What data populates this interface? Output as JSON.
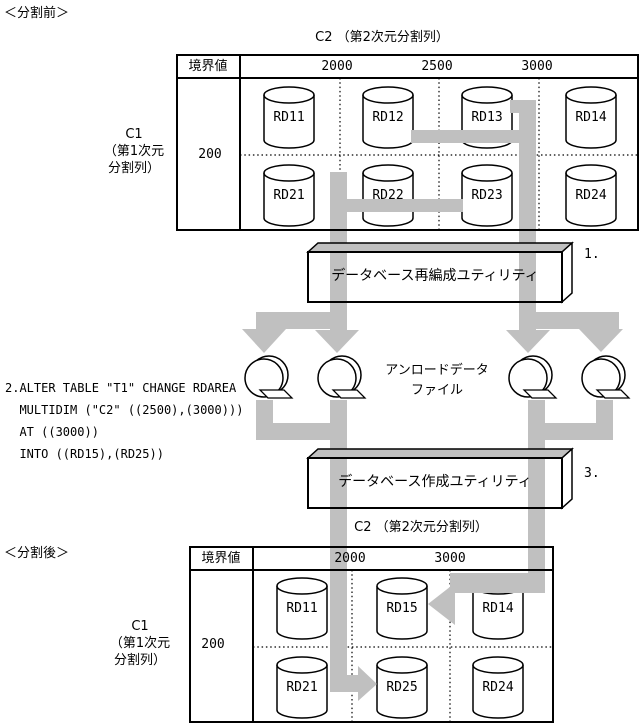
{
  "tags": {
    "before": "＜分割前＞",
    "after": "＜分割後＞"
  },
  "before_table": {
    "title": "C2 （第2次元分割列）",
    "boundary_header": "境界値",
    "c1_label_lines": [
      "C1",
      "（第1次元",
      "分割列）"
    ],
    "c1_boundary": "200",
    "col_boundaries": [
      "2000",
      "2500",
      "3000"
    ],
    "row1": [
      "RD11",
      "RD12",
      "RD13",
      "RD14"
    ],
    "row2": [
      "RD21",
      "RD22",
      "RD23",
      "RD24"
    ]
  },
  "after_table": {
    "title": "C2 （第2次元分割列）",
    "boundary_header": "境界値",
    "c1_label_lines": [
      "C1",
      "（第1次元",
      "分割列）"
    ],
    "c1_boundary": "200",
    "col_boundaries": [
      "2000",
      "3000"
    ],
    "row1": [
      "RD11",
      "RD15",
      "RD14"
    ],
    "row2": [
      "RD21",
      "RD25",
      "RD24"
    ]
  },
  "boxes": {
    "reorg": "データベース再編成ユティリティ",
    "create": "データベース作成ユティリティ"
  },
  "steps": {
    "step1": "1.",
    "step3": "3."
  },
  "unload_label": {
    "line1": "アンロードデータ",
    "line2": "ファイル"
  },
  "sql": {
    "line1": "2.ALTER TABLE \"T1\" CHANGE RDAREA",
    "line2": "  MULTIDIM (\"C2\" ((2500),(3000)))",
    "line3": "  AT ((3000))",
    "line4": "  INTO ((RD15),(RD25))"
  },
  "colors": {
    "arrow_gray": "#c0c0c0",
    "line_black": "#000000"
  }
}
